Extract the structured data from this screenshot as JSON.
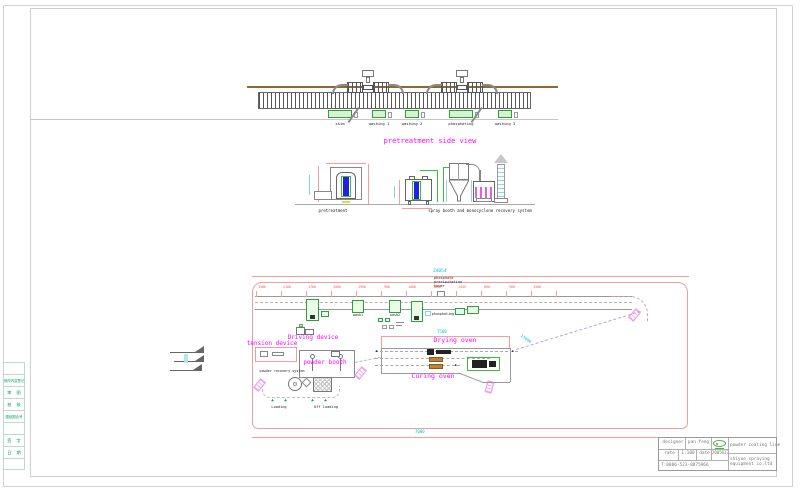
{
  "colors": {
    "magenta": "#ff00ff",
    "green": "#2e9e3e",
    "red": "#ff5050",
    "cyan": "#00c4c4",
    "blue": "#2222dd",
    "brown": "#8a6a32"
  },
  "icons": {
    "drop_marker": "◢◣",
    "arrow_right": "▶"
  },
  "side_view": {
    "title": "pretreatment side view",
    "tank_labels": [
      "skim",
      "washing 1",
      "washing 2",
      "phosphating",
      "washing 3"
    ]
  },
  "sections": {
    "pretreatment_label": "pretreatment",
    "spray_label": "spray booth and monocyclone recovery system"
  },
  "plan": {
    "overall_dim": "24054",
    "bottom_dim": "7000",
    "drying_dim": "7500",
    "diag_dim": "15000",
    "note": "phosphate\nprecipitation\ntower",
    "tank1": "wash1",
    "tank2": "wash2",
    "tank3": "phosphating",
    "driving": "Driving device",
    "tension": "tension device",
    "powder_booth": "powder booth",
    "powder_recovery": "powder recovery system",
    "drying_oven": "Drying oven",
    "curing_oven": "Curing oven",
    "loading": "Loading",
    "offloading": "Off loading",
    "red_dims": [
      "1500",
      "2100",
      "1700",
      "3000",
      "1950",
      "900",
      "1000",
      "1800",
      "1445",
      "600",
      "900",
      "1500"
    ]
  },
  "title_block": {
    "designer_label": "designer",
    "designer_value": "pan feng",
    "rate_label": "rate",
    "rate_value": "1:100",
    "date_label": "date",
    "date_value": "2005617",
    "phone": "T:0086-523-8875966",
    "product": "powder coating line",
    "company": "shiyue spraying\nequipment co.ltd"
  },
  "rev_table": {
    "rows": [
      "",
      "修改内容签记",
      "审  图",
      "校  核",
      "图纸图合号",
      "",
      "签  字",
      "日  期",
      ""
    ]
  }
}
